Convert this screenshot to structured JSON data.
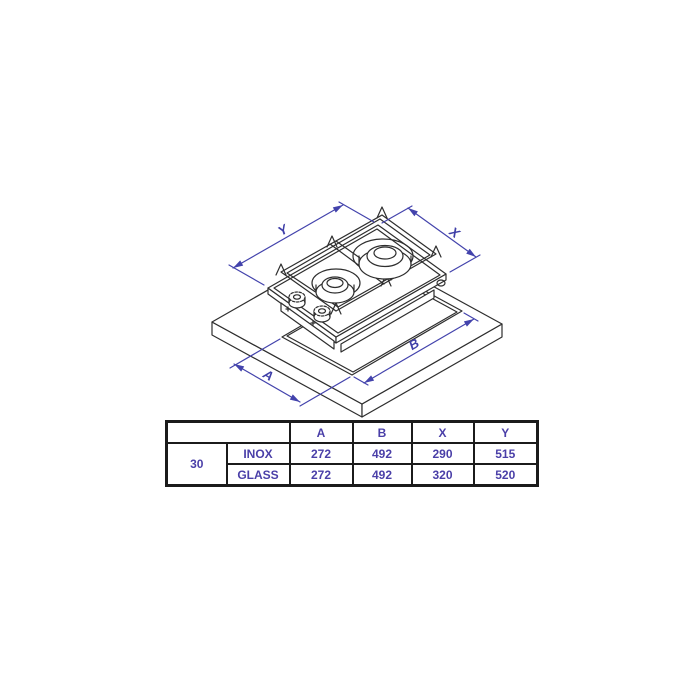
{
  "diagram": {
    "description": "Isometric technical drawing of a 2-burner domino gas hob installed over a countertop cutout",
    "labels": {
      "y": "Y",
      "x": "X",
      "a": "A",
      "b": "B"
    },
    "colors": {
      "line": "#2e2e2e",
      "dimension": "#4343ac"
    }
  },
  "table": {
    "colors": {
      "text": "#4a3fa8",
      "border": "#1b1b1b"
    },
    "header": {
      "blank": "",
      "cols": [
        "A",
        "B",
        "X",
        "Y"
      ]
    },
    "size_label": "30",
    "rows": [
      {
        "variant": "INOX",
        "values": [
          "272",
          "492",
          "290",
          "515"
        ]
      },
      {
        "variant": "GLASS",
        "values": [
          "272",
          "492",
          "320",
          "520"
        ]
      }
    ]
  }
}
